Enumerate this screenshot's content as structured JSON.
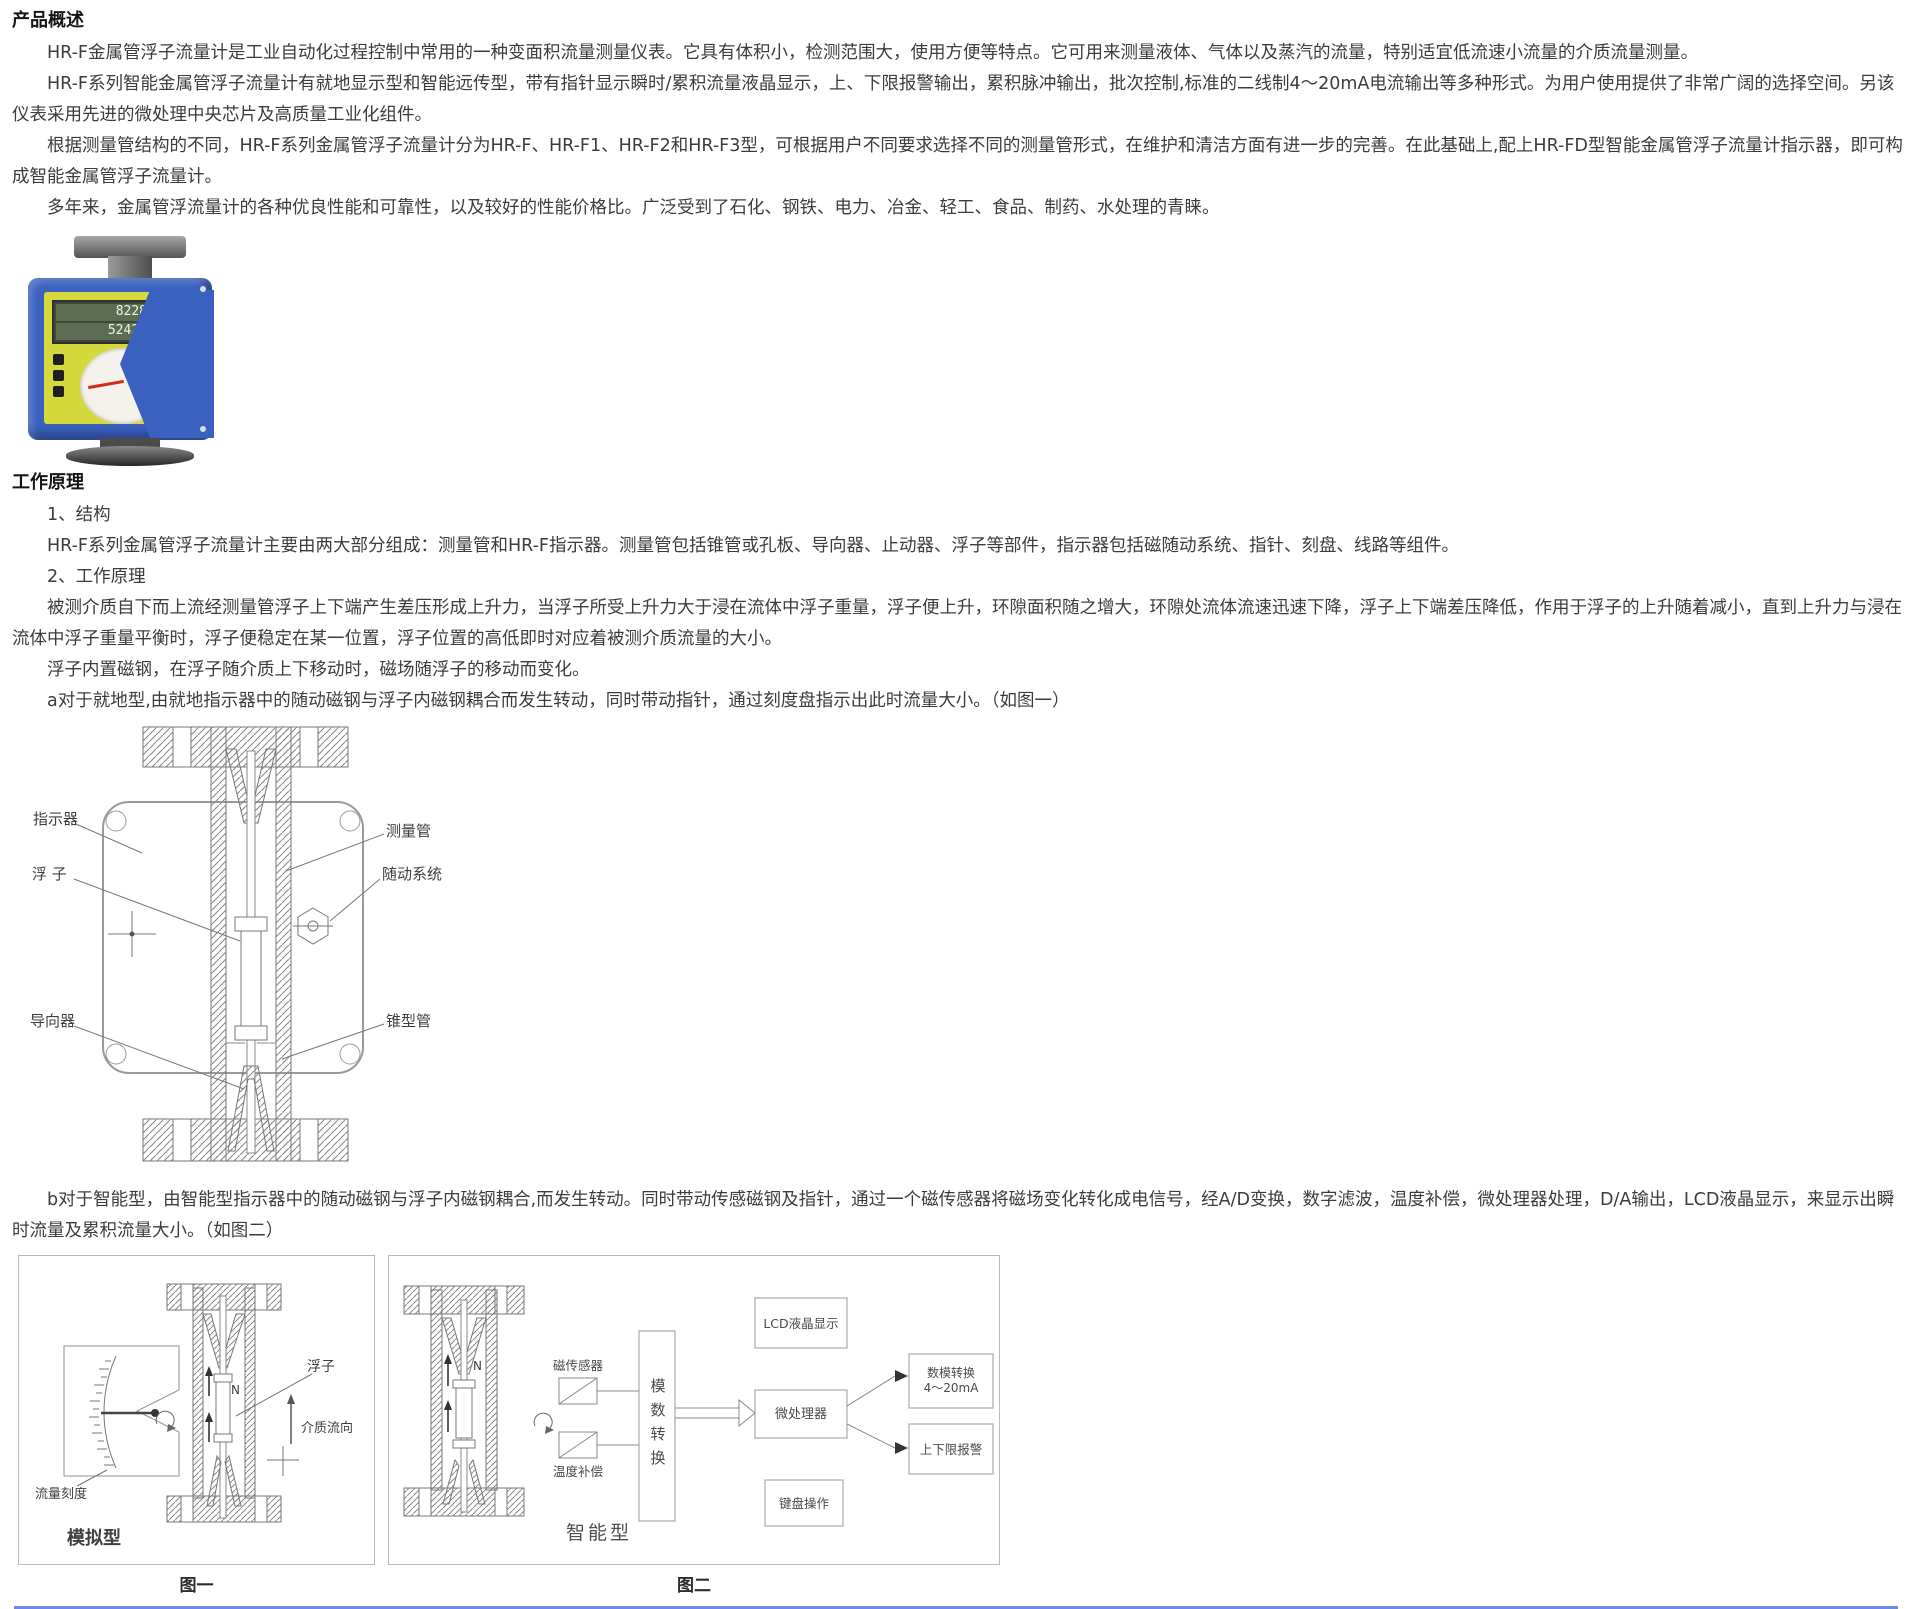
{
  "colors": {
    "page_bg": "#ffffff",
    "text": "#3c3c3c",
    "photo_body_blue": "#3a61c0",
    "photo_panel_yellow": "#d6d93c",
    "photo_needle_red": "#cf2b1e",
    "diagram_stroke_gray": "#8a8a8a",
    "bottom_divider_blue": "#6b8be0"
  },
  "overview": {
    "heading": "产品概述",
    "paragraphs": [
      "HR-F金属管浮子流量计是工业自动化过程控制中常用的一种变面积流量测量仪表。它具有体积小，检测范围大，使用方便等特点。它可用来测量液体、气体以及蒸汽的流量，特别适宜低流速小流量的介质流量测量。",
      "HR-F系列智能金属管浮子流量计有就地显示型和智能远传型，带有指针显示瞬时/累积流量液晶显示，上、下限报警输出，累积脉冲输出，批次控制,标准的二线制4～20mA电流输出等多种形式。为用户使用提供了非常广阔的选择空间。另该仪表采用先进的微处理中央芯片及高质量工业化组件。",
      "根据测量管结构的不同，HR-F系列金属管浮子流量计分为HR-F、HR-F1、HR-F2和HR-F3型，可根据用户不同要求选择不同的测量管形式，在维护和清洁方面有进一步的完善。在此基础上,配上HR-FD型智能金属管浮子流量计指示器，即可构成智能金属管浮子流量计。",
      "多年来，金属管浮流量计的各种优良性能和可靠性，以及较好的性能价格比。广泛受到了石化、钢铁、电力、冶金、轻工、食品、制药、水处理的青睐。"
    ]
  },
  "product_photo": {
    "lcd_line1": "8228",
    "lcd_line2": "52420"
  },
  "principle": {
    "heading": "工作原理",
    "item1": "1、结构",
    "structure_text": "HR-F系列金属管浮子流量计主要由两大部分组成：测量管和HR-F指示器。测量管包括锥管或孔板、导向器、止动器、浮子等部件，指示器包括磁随动系统、指针、刻盘、线路等组件。",
    "item2": "2、工作原理",
    "flow_text": "被测介质自下而上流经测量管浮子上下端产生差压形成上升力，当浮子所受上升力大于浸在流体中浮子重量，浮子便上升，环隙面积随之增大，环隙处流体流速迅速下降，浮子上下端差压降低，作用于浮子的上升随着减小，直到上升力与浸在流体中浮子重量平衡时，浮子便稳定在某一位置，浮子位置的高低即时对应着被测介质流量的大小。",
    "magnet_text": "浮子内置磁钢，在浮子随介质上下移动时，磁场随浮子的移动而变化。",
    "a_text": "a对于就地型,由就地指示器中的随动磁钢与浮子内磁钢耦合而发生转动，同时带动指针，通过刻度盘指示出此时流量大小。（如图一）",
    "b_text": "b对于智能型，由智能型指示器中的随动磁钢与浮子内磁钢耦合,而发生转动。同时带动传感磁钢及指针，通过一个磁传感器将磁场变化转化成电信号，经A/D变换，数字滤波，温度补偿，微处理器处理，D/A输出，LCD液晶显示，来显示出瞬时流量及累积流量大小。（如图二）"
  },
  "diagram1": {
    "labels": {
      "indicator": "指示器",
      "float": "浮 子",
      "guide": "导向器",
      "measuring_tube": "测量管",
      "follower_system": "随动系统",
      "cone_tube": "锥型管"
    }
  },
  "figure1": {
    "float_label": "浮子",
    "flow_direction": "介质流向",
    "flow_scale": "流量刻度",
    "type_label": "模拟型",
    "n_mark": "N",
    "caption": "图一"
  },
  "figure2": {
    "magnetic_sensor": "磁传感器",
    "temp_comp": "温度补偿",
    "adc": "模数转换",
    "mcu": "微处理器",
    "lcd": "LCD液晶显示",
    "keyboard": "键盘操作",
    "da_line1": "数模转换",
    "da_line2": "4～20mA",
    "alarm": "上下限报警",
    "type_label": "智能型",
    "n_mark": "N",
    "caption": "图二"
  }
}
